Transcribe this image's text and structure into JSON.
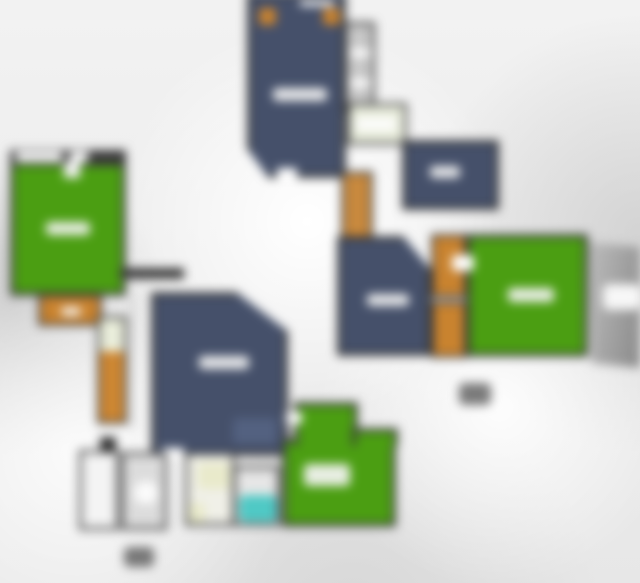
{
  "meta": {
    "content_type": "blurred residential floor plan, two floor plates, no legible text",
    "visible_text": "none (all labels are illegible blurred blobs)"
  },
  "palette": {
    "wall": "#3a3a3a",
    "room_navy": "#45506a",
    "room_green": "#4b9e12",
    "closet_orange": "#c9832f",
    "stairs_orange": "#cd8733",
    "bathtub_cyan": "#4fc9c5",
    "fixture_cream": "#e9eacb",
    "deck_gray": "#a3a3a3",
    "label_blob": "#f5f5f5",
    "marker_dark": "#565656"
  },
  "floors": {
    "upper_plate": {
      "rooms": [
        {
          "id": "bedroom-top",
          "fill": "room_navy",
          "features": [
            "two orange corner pillows",
            "white label blob",
            "top window gap",
            "bottom door gap",
            "clipped bottom-left corner"
          ]
        },
        {
          "id": "closet-strip",
          "fill": "gray",
          "features": [
            "white shelf bars"
          ]
        },
        {
          "id": "small-bath",
          "fill": "pale-green-white",
          "features": [
            "white fixture"
          ]
        },
        {
          "id": "bedroom-northeast",
          "fill": "room_navy",
          "features": [
            "white label blob"
          ]
        },
        {
          "id": "stairs",
          "fill": "stairs_orange",
          "features": [
            "rung lines"
          ]
        },
        {
          "id": "bedroom-middle",
          "fill": "room_navy",
          "features": [
            "clipped top-right corner",
            "white label blob"
          ]
        },
        {
          "id": "closet-a",
          "fill": "closet_orange"
        },
        {
          "id": "closet-b",
          "fill": "closet_orange"
        },
        {
          "id": "green-room-right",
          "fill": "room_green",
          "features": [
            "white label blob"
          ]
        },
        {
          "id": "gray-deck",
          "fill": "deck_gray",
          "features": [
            "white notch on right edge"
          ]
        }
      ],
      "floor_marker": {
        "id": "upper-floor-marker",
        "legible": false
      }
    },
    "lower_plate": {
      "rooms": [
        {
          "id": "green-room-left",
          "fill": "room_green",
          "features": [
            "white window gaps in top wall",
            "door gap",
            "white label blob"
          ]
        },
        {
          "id": "orange-deck",
          "fill": "closet_orange",
          "features": [
            "small white label blob"
          ]
        },
        {
          "id": "stairs",
          "fill": "stairs_orange",
          "features": [
            "light landing at top",
            "rung lines"
          ]
        },
        {
          "id": "navy-room-center",
          "fill": "room_navy",
          "features": [
            "clipped top-right corner",
            "white label blob",
            "light furniture patch",
            "bottom door gap"
          ]
        },
        {
          "id": "utility-room",
          "fill": "white",
          "features": [
            "dark heater box above"
          ]
        },
        {
          "id": "toilet-room",
          "fill": "light-gray",
          "features": [
            "white toilet oval"
          ]
        },
        {
          "id": "wash-room",
          "fill": "off-white",
          "features": [
            "cream counter",
            "cream sink"
          ]
        },
        {
          "id": "bath-room",
          "fill": "light-gray",
          "features": [
            "cyan bathtub"
          ]
        },
        {
          "id": "green-room-bottom",
          "fill": "room_green",
          "features": [
            "top bump extension",
            "right step",
            "white door blob",
            "large white label blob"
          ]
        }
      ],
      "floor_marker": {
        "id": "lower-floor-marker",
        "legible": false
      }
    }
  }
}
